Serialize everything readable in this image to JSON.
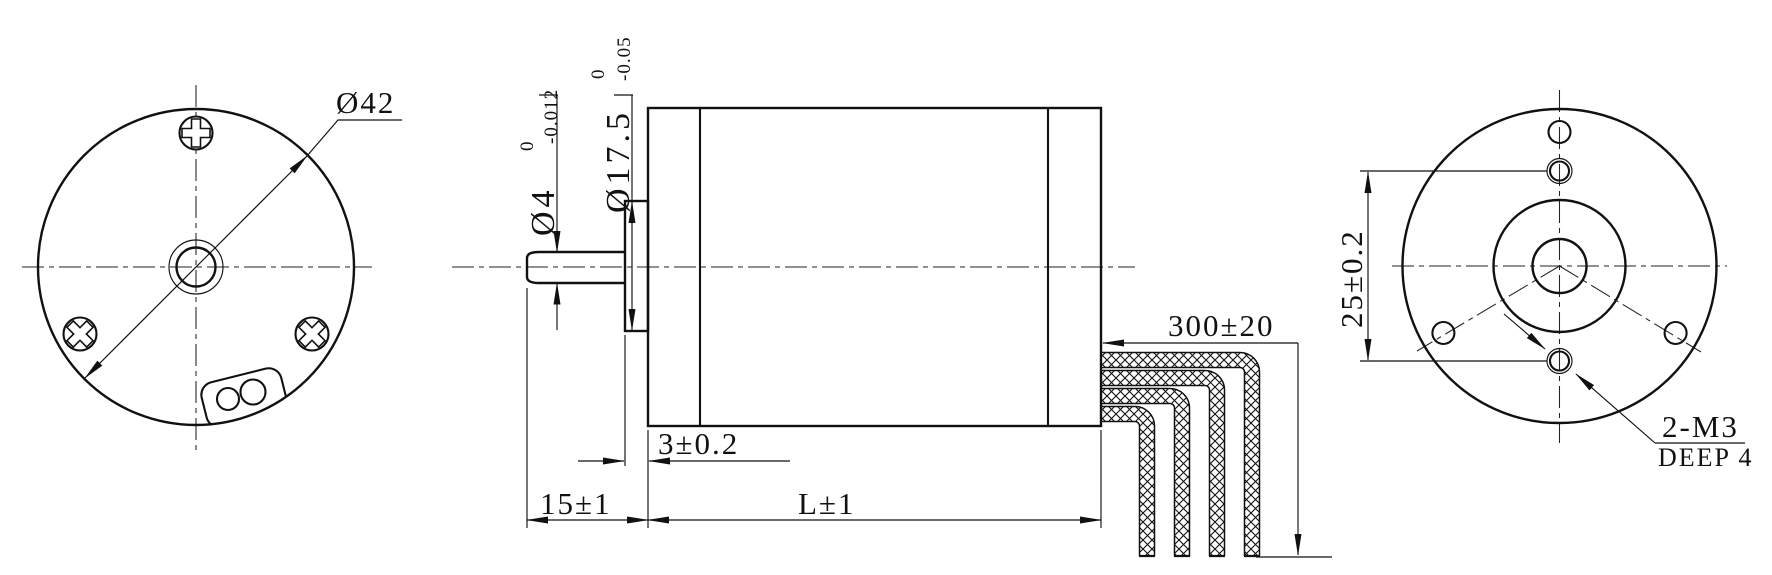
{
  "drawing": {
    "front_view": {
      "outer_diameter": "Ø42"
    },
    "side_view": {
      "shaft_diameter": {
        "value": "Ø4",
        "upper_tol": "0",
        "lower_tol": "-0.012"
      },
      "pilot_diameter": {
        "value": "Ø17.5",
        "upper_tol": "0",
        "lower_tol": "-0.05"
      },
      "pilot_length": "3±0.2",
      "shaft_extension": "15±1",
      "body_length": "L±1",
      "lead_wire_length": "300±20"
    },
    "rear_view": {
      "screw_hole_spacing": "25±0.2",
      "thread_spec": "2-M3",
      "thread_depth": "DEEP 4"
    }
  }
}
